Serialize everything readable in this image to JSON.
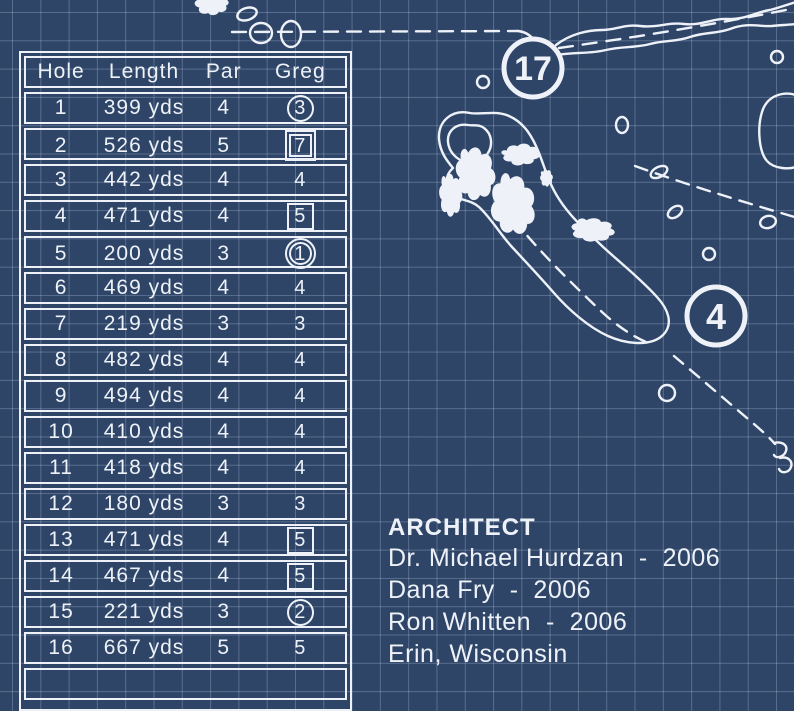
{
  "theme": {
    "background": "#2e4568",
    "grid_line": "rgba(205,219,240,0.27)",
    "ink": "#eef2f8"
  },
  "scorecard": {
    "headers": [
      "Hole",
      "Length",
      "Par",
      "Greg"
    ],
    "rows": [
      {
        "hole": "1",
        "length": "399 yds",
        "par": "4",
        "score": "3",
        "marker": "circle"
      },
      {
        "hole": "2",
        "length": "526 yds",
        "par": "5",
        "score": "7",
        "marker": "double-square"
      },
      {
        "hole": "3",
        "length": "442 yds",
        "par": "4",
        "score": "4",
        "marker": "none"
      },
      {
        "hole": "4",
        "length": "471 yds",
        "par": "4",
        "score": "5",
        "marker": "square"
      },
      {
        "hole": "5",
        "length": "200 yds",
        "par": "3",
        "score": "1",
        "marker": "double-circle"
      },
      {
        "hole": "6",
        "length": "469 yds",
        "par": "4",
        "score": "4",
        "marker": "none"
      },
      {
        "hole": "7",
        "length": "219 yds",
        "par": "3",
        "score": "3",
        "marker": "none"
      },
      {
        "hole": "8",
        "length": "482 yds",
        "par": "4",
        "score": "4",
        "marker": "none"
      },
      {
        "hole": "9",
        "length": "494 yds",
        "par": "4",
        "score": "4",
        "marker": "none"
      },
      {
        "hole": "10",
        "length": "410 yds",
        "par": "4",
        "score": "4",
        "marker": "none"
      },
      {
        "hole": "11",
        "length": "418 yds",
        "par": "4",
        "score": "4",
        "marker": "none"
      },
      {
        "hole": "12",
        "length": "180 yds",
        "par": "3",
        "score": "3",
        "marker": "none"
      },
      {
        "hole": "13",
        "length": "471 yds",
        "par": "4",
        "score": "5",
        "marker": "square"
      },
      {
        "hole": "14",
        "length": "467 yds",
        "par": "4",
        "score": "5",
        "marker": "square"
      },
      {
        "hole": "15",
        "length": "221 yds",
        "par": "3",
        "score": "2",
        "marker": "circle"
      },
      {
        "hole": "16",
        "length": "667 yds",
        "par": "5",
        "score": "5",
        "marker": "none"
      }
    ]
  },
  "architect": {
    "heading": "ARCHITECT",
    "lines": [
      "Dr. Michael Hurdzan  -  2006",
      "Dana Fry  -  2006",
      "Ron Whitten  -  2006",
      "Erin, Wisconsin"
    ]
  },
  "map": {
    "labels": [
      {
        "number": "17"
      },
      {
        "number": "4"
      }
    ]
  }
}
